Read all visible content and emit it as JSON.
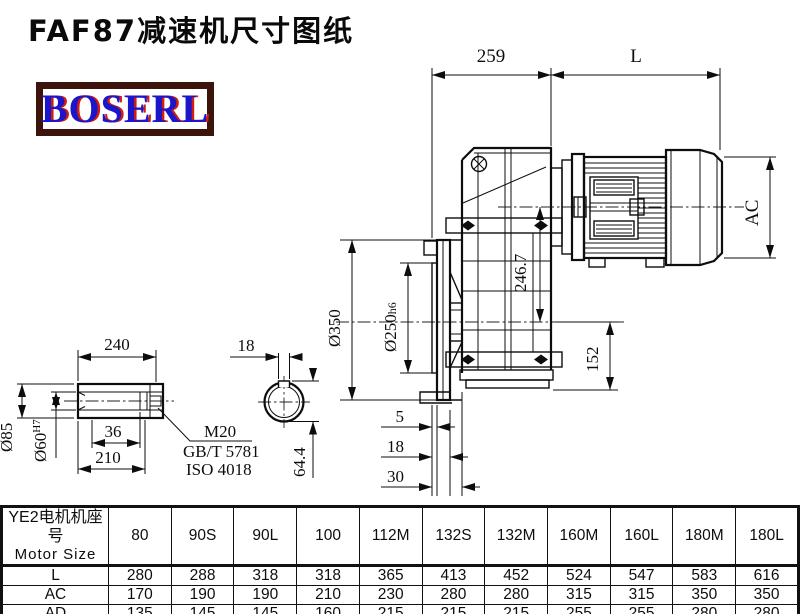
{
  "title": "FAF87减速机尺寸图纸",
  "logo": {
    "text": "BOSERL",
    "border_color": "#3c140b",
    "text_color": "#1b16c9",
    "shadow_color": "#cf1d12"
  },
  "drawing": {
    "top_dims": {
      "front_length": "259",
      "motor_length": "L"
    },
    "motor_dims": {
      "ac": "AC",
      "axis_offset": "246.7"
    },
    "flange_dims": {
      "outer_dia": "Ø350",
      "pilot_dia_base": "Ø250",
      "pilot_dia_tol": "h6",
      "case_bottom": "152",
      "pilot_depth": "5",
      "flange_thickness": "18",
      "total_depth": "30"
    },
    "shaft_dims": {
      "length": "240",
      "outer_dia": "Ø85",
      "bore_dia_base": "Ø60",
      "bore_dia_tol": "H7",
      "step": "36",
      "bore_depth": "210",
      "key_width": "18",
      "key_height": "64.4"
    },
    "thread_note": {
      "size": "M20",
      "standard1": "GB/T 5781",
      "standard2": "ISO 4018"
    }
  },
  "table": {
    "header_cn": "YE2电机机座号",
    "header_en": "Motor Size",
    "columns": [
      "80",
      "90S",
      "90L",
      "100",
      "112M",
      "132S",
      "132M",
      "160M",
      "160L",
      "180M",
      "180L"
    ],
    "rows": [
      {
        "label": "L",
        "values": [
          "280",
          "288",
          "318",
          "318",
          "365",
          "413",
          "452",
          "524",
          "547",
          "583",
          "616"
        ]
      },
      {
        "label": "AC",
        "values": [
          "170",
          "190",
          "190",
          "210",
          "230",
          "280",
          "280",
          "315",
          "315",
          "350",
          "350"
        ]
      },
      {
        "label": "AD",
        "values": [
          "135",
          "145",
          "145",
          "160",
          "215",
          "215",
          "215",
          "255",
          "255",
          "280",
          "280"
        ]
      }
    ]
  }
}
